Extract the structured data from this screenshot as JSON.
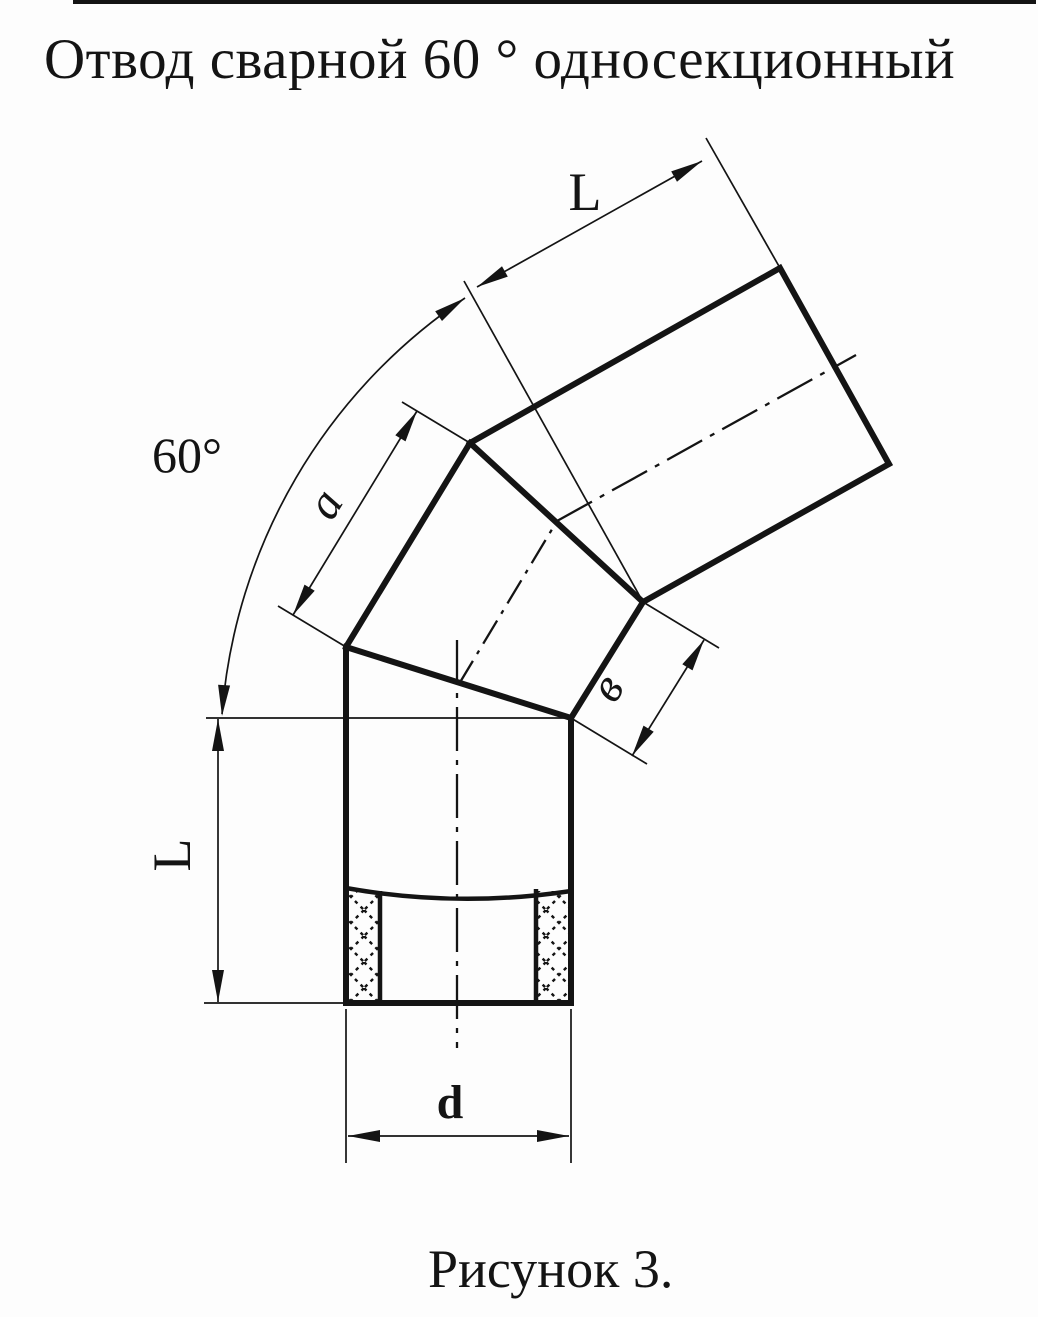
{
  "title": "Отвод сварной 60 ° односекционный",
  "figure_caption": "Рисунок 3.",
  "labels": {
    "upper_length": "L",
    "bend_angle": "60°",
    "outer_segment": "a",
    "inner_segment": "в",
    "lower_length": "L",
    "diameter": "d"
  },
  "colors": {
    "ink": "#141414",
    "paper": "#fdfdfd"
  }
}
